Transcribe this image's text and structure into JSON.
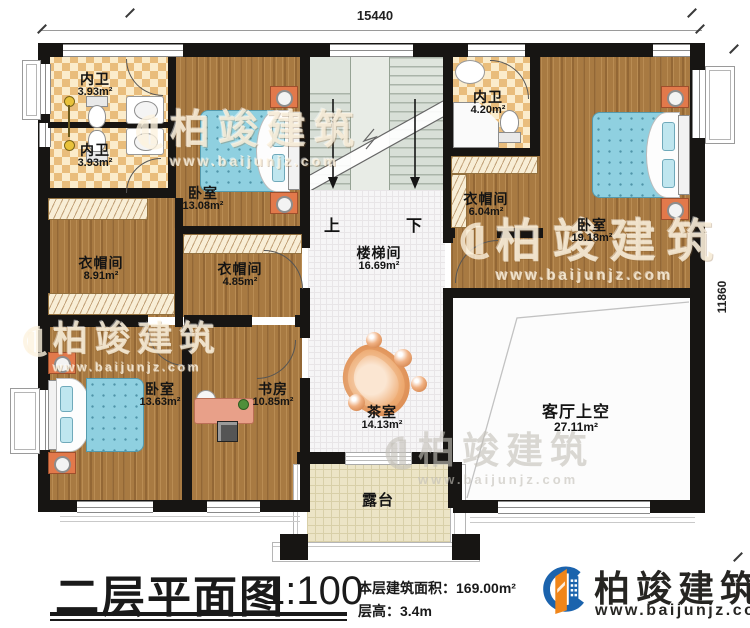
{
  "dimensions": {
    "top": "15440",
    "right": "11860"
  },
  "stairs": {
    "up": "上",
    "down": "下"
  },
  "rooms": {
    "bath1": {
      "name": "内卫",
      "area": "3.93m²"
    },
    "bath2": {
      "name": "内卫",
      "area": "3.93m²"
    },
    "bedroom1": {
      "name": "卧室",
      "area": "13.08m²"
    },
    "closet1": {
      "name": "衣帽间",
      "area": "8.91m²"
    },
    "closet2": {
      "name": "衣帽间",
      "area": "4.85m²"
    },
    "stairwell": {
      "name": "楼梯间",
      "area": "16.69m²"
    },
    "bath3": {
      "name": "内卫",
      "area": "4.20m²"
    },
    "closet3": {
      "name": "衣帽间",
      "area": "6.04m²"
    },
    "bedroom2": {
      "name": "卧室",
      "area": "19.18m²"
    },
    "bedroom3": {
      "name": "卧室",
      "area": "13.63m²"
    },
    "study": {
      "name": "书房",
      "area": "10.85m²"
    },
    "tearoom": {
      "name": "茶室",
      "area": "14.13m²"
    },
    "void": {
      "name": "客厅上空",
      "area": "27.11m²"
    },
    "terrace": {
      "name": "露台"
    }
  },
  "titleblock": {
    "title": "二层平面图",
    "scale": "1:100",
    "floor_area": "本层建筑面积：169.00m²",
    "floor_height": "层高：3.4m"
  },
  "brand": {
    "name": "柏竣建筑",
    "url": "www.baijunjz.com"
  },
  "watermark": {
    "name": "柏竣建筑",
    "url": "www.baijunjz.com"
  },
  "colors": {
    "wall": "#171513",
    "wood": "#a87a42",
    "checker": "#e9bd7c",
    "bed": "#8fd0e0",
    "brand_blue": "#1b63ad",
    "brand_orange": "#f08519"
  }
}
